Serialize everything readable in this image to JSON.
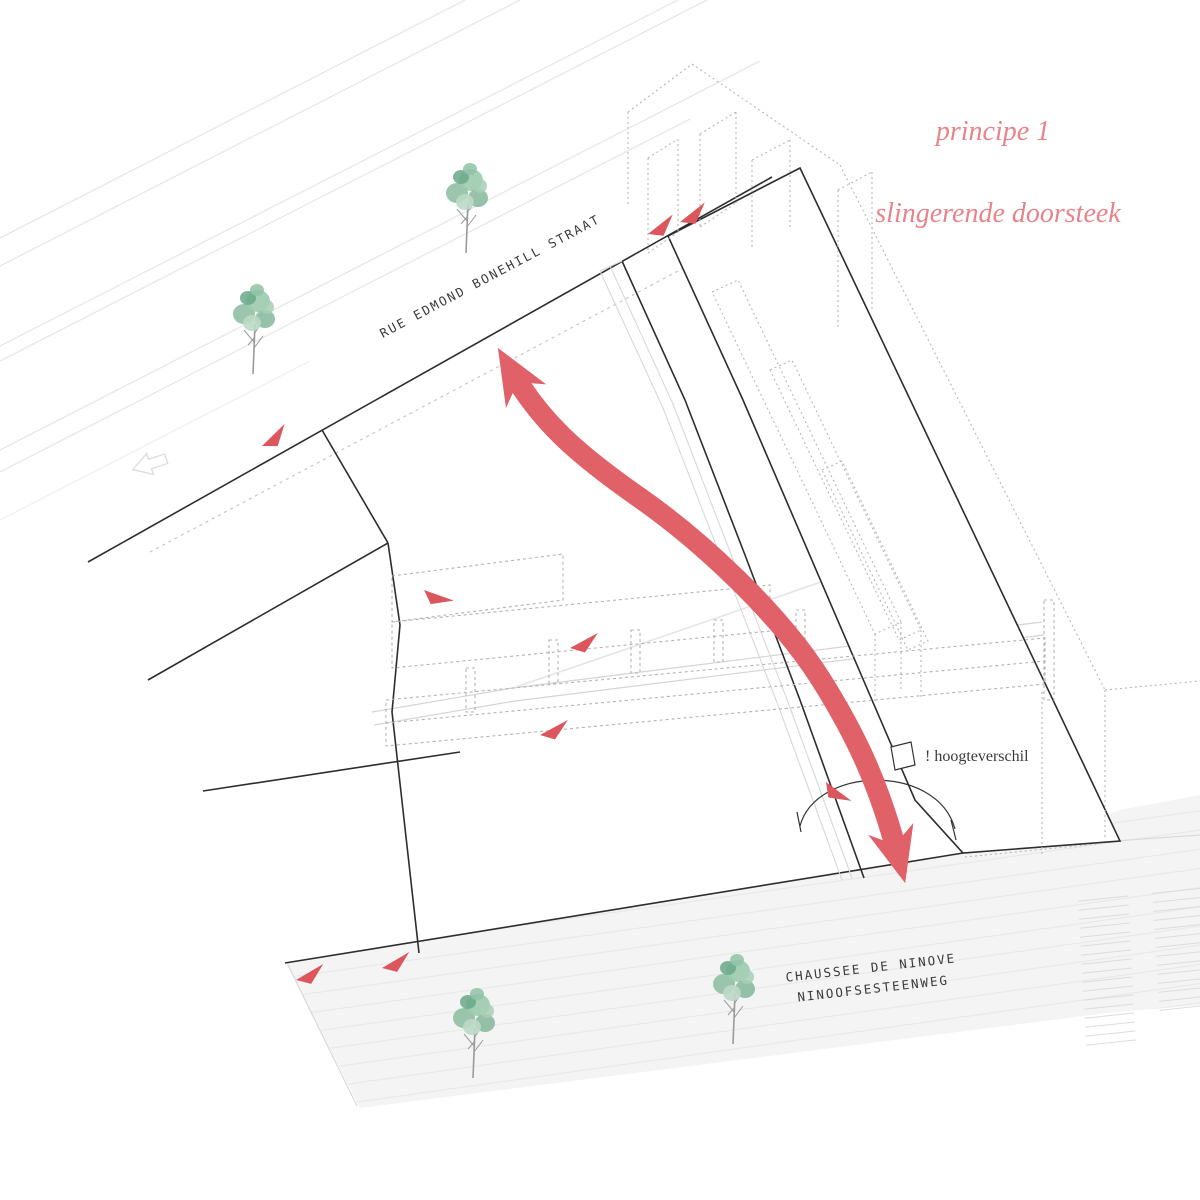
{
  "title": {
    "line1": "principe 1",
    "line2": "slingerende doorsteek"
  },
  "streets": {
    "top": "RUE EDMOND BONEHILL STRAAT",
    "bottom_line1": "CHAUSSEE DE NINOVE",
    "bottom_line2": "NINOOFSESTEENWEG"
  },
  "annotations": {
    "height_note": "! hoogteverschil"
  },
  "icons": {
    "route_arrow": "double-headed-s-curve-arrow",
    "direction_triangle": "small-red-triangle",
    "street_arrow": "hollow-left-arrow",
    "tree": "watercolor-tree"
  },
  "counts": {
    "trees": 4,
    "direction_triangles": 9
  },
  "colors": {
    "arrow_red": "#e06168",
    "triangle_red": "#dc575d",
    "title_pink": "#e8838a",
    "ink": "#2d2d2d",
    "line_gray": "#e7e7e7",
    "dash_gray": "#b3b3b3",
    "road_fill": "#f4f4f4",
    "tree_green": "#8abb9d"
  }
}
